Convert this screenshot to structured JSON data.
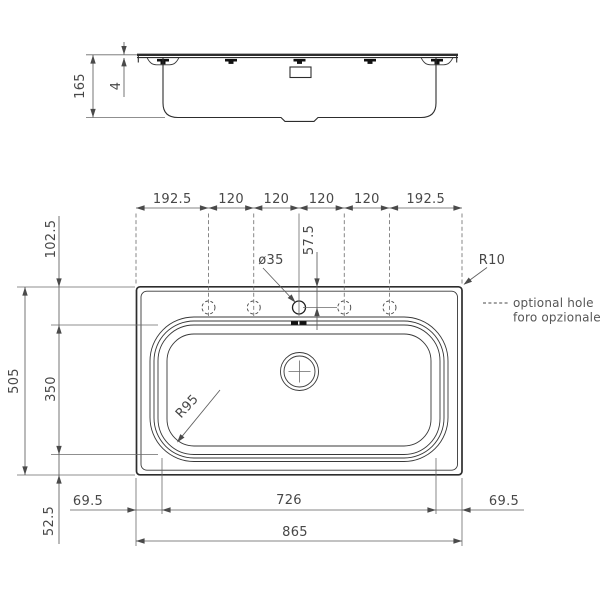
{
  "colors": {
    "geometry_line": "#2d2d2d",
    "dimension_line": "#5e5e5e",
    "text": "#4a4a4a",
    "background": "#ffffff"
  },
  "side_view": {
    "overall_depth": "165",
    "rim_height": "4"
  },
  "plan_view": {
    "top_chain": [
      "192.5",
      "120",
      "120",
      "120",
      "120",
      "192.5"
    ],
    "tap_hole_diameter": "ø35",
    "tap_hole_center_offset": "57.5",
    "corner_radius": "R10",
    "bowl_corner_radius": "R95",
    "legend": [
      "optional hole",
      "foro opzionale"
    ],
    "left_chain": {
      "overall_depth": "505",
      "bowl_depth": "350",
      "back_ledge": "102.5",
      "front_ledge": "52.5"
    },
    "bottom_chain": {
      "left_ledge": "69.5",
      "bowl_width": "726",
      "right_ledge": "69.5",
      "overall_width": "865"
    }
  }
}
